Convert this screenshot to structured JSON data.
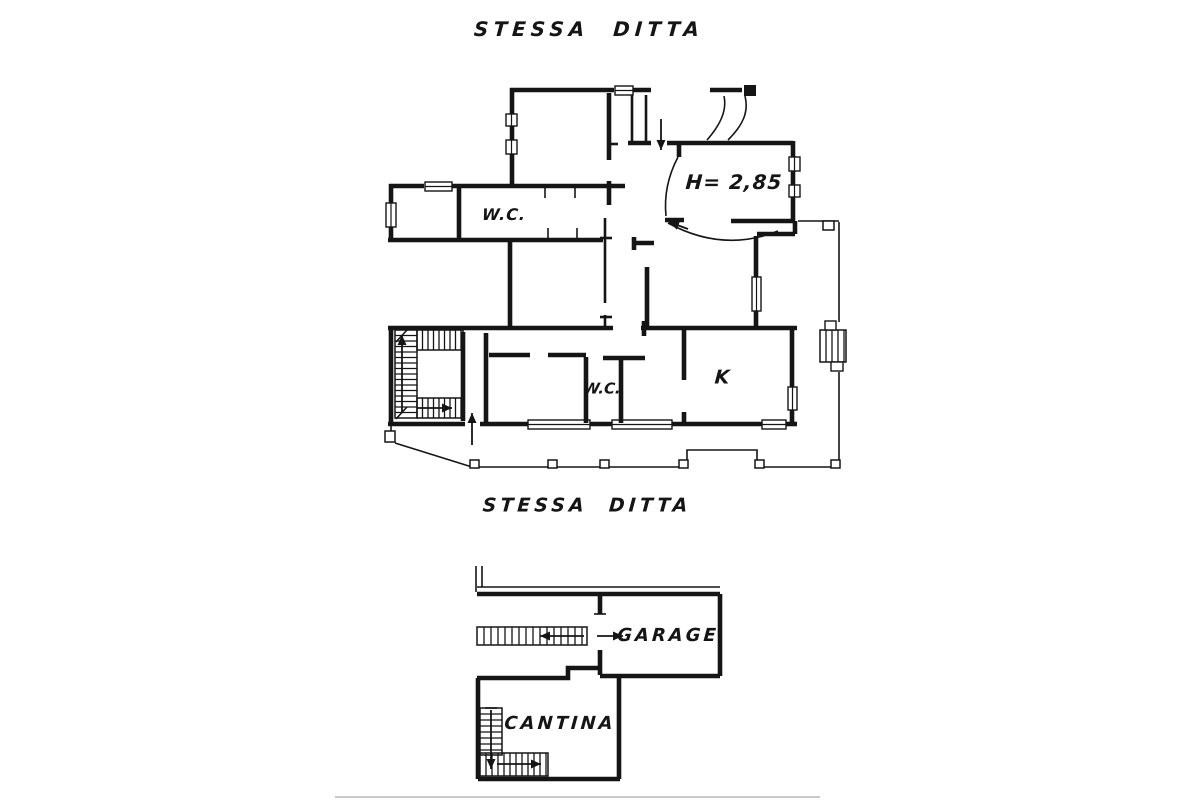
{
  "colors": {
    "ink": "#151515",
    "paper": "#ffffff",
    "faint": "#c9c9c9"
  },
  "labels": [
    {
      "id": "title-upper",
      "text": "STESSA  DITTA",
      "x": 589,
      "y": 29,
      "size": 20,
      "ls": 5
    },
    {
      "id": "title-lower",
      "text": "STESSA  DITTA",
      "x": 587,
      "y": 506,
      "size": 19,
      "ls": 4
    },
    {
      "id": "wc-upper",
      "text": "W.C.",
      "x": 504,
      "y": 215,
      "size": 16,
      "ls": 1
    },
    {
      "id": "height-note",
      "text": "H= 2,85",
      "x": 734,
      "y": 182,
      "size": 20,
      "ls": 1
    },
    {
      "id": "wc-lower",
      "text": "W.C.",
      "x": 602,
      "y": 389,
      "size": 15,
      "ls": 0
    },
    {
      "id": "kitchen",
      "text": "K",
      "x": 722,
      "y": 378,
      "size": 19,
      "ls": 0
    },
    {
      "id": "garage",
      "text": "GARAGE",
      "x": 668,
      "y": 636,
      "size": 18,
      "ls": 3
    },
    {
      "id": "cantina",
      "text": "CANTINA",
      "x": 560,
      "y": 724,
      "size": 18,
      "ls": 3
    }
  ],
  "drawing": {
    "thick": [
      "M 510,90 H 614",
      "M 633,90 H 651",
      "M 512,88 V 114",
      "M 512,126 V 140",
      "M 512,154 V 185",
      "M 628,143 H 651",
      "M 609,93 V 160",
      "M 609,181 V 205",
      "M 389,186 H 424",
      "M 452,186 H 625",
      "M 391,184 V 203",
      "M 391,227 V 242",
      "M 388,240 H 603",
      "M 459,188 V 238",
      "M 510,240 V 328",
      "M 667,143 H 793",
      "M 679,145 V 157",
      "M 665,220 H 684",
      "M 793,141 V 157",
      "M 793,171 V 185",
      "M 793,197 V 223",
      "M 731,221 H 795",
      "M 795,221 V 234",
      "M 757,234 H 795",
      "M 756,236 V 277",
      "M 756,311 V 330",
      "M 634,243 H 654",
      "M 634,237 V 250",
      "M 647,267 V 328",
      "M 388,328 H 613",
      "M 641,328 H 797",
      "M 644,321 V 336",
      "M 684,330 V 380",
      "M 684,412 V 423",
      "M 792,330 V 387",
      "M 792,410 V 423",
      "M 391,330 V 424",
      "M 463,332 V 421",
      "M 486,333 V 423",
      "M 489,355 H 530",
      "M 548,355 H 586",
      "M 586,357 V 423",
      "M 603,358 H 645",
      "M 621,360 V 423",
      "M 388,424 H 465",
      "M 480,424 H 528",
      "M 590,424 H 612",
      "M 672,424 H 762",
      "M 786,424 H 797",
      "M 710,90 H 742",
      "M 477,594 H 720",
      "M 600,596 V 614",
      "M 600,650 V 675",
      "M 720,594 V 676",
      "M 600,676 H 720",
      "M 477,678 H 568 V 668 H 598",
      "M 478,678 V 779",
      "M 478,779 H 620",
      "M 619,678 V 779"
    ],
    "medium": [
      "M 632,95 V 141",
      "M 646,95 V 141",
      "M 605,218 V 303",
      "M 600,238 H 612",
      "M 605,315 V 327",
      "M 600,317 H 612",
      "M 609,144 H 618"
    ],
    "thin": [
      "M 477,587 H 720",
      "M 476,566 V 592",
      "M 482,566 V 587",
      "M 594,614 H 606",
      "M 678,157 C 668,176 664,196 666,216",
      "M 668,223 Q 723,253 778,231",
      "M 745,96 C 749,112 743,125 728,140",
      "M 724,96 C 727,110 721,124 707,140",
      "M 391,426 V 442",
      "M 395,443 L 472,467",
      "M 472,467 H 687",
      "M 687,467 V 450 H 757 V 467",
      "M 757,467 H 839",
      "M 839,467 V 372",
      "M 839,322 V 222",
      "M 798,221 H 839",
      "M 548,228 V 239",
      "M 577,228 V 239",
      "M 545,188 V 198",
      "M 575,188 V 198",
      "M 485,708 H 497",
      "M 396,342 L 407,330",
      "M 396,419 L 407,407"
    ],
    "faint": [
      "M 335,797 H 820"
    ],
    "windows": [
      {
        "x": 615,
        "y": 86,
        "w": 18,
        "h": 9
      },
      {
        "x": 425,
        "y": 182,
        "w": 27,
        "h": 9
      },
      {
        "x": 386,
        "y": 203,
        "w": 10,
        "h": 24
      },
      {
        "x": 506,
        "y": 114,
        "w": 11,
        "h": 12
      },
      {
        "x": 506,
        "y": 140,
        "w": 11,
        "h": 14
      },
      {
        "x": 789,
        "y": 157,
        "w": 11,
        "h": 14
      },
      {
        "x": 789,
        "y": 185,
        "w": 11,
        "h": 12
      },
      {
        "x": 752,
        "y": 277,
        "w": 9,
        "h": 34
      },
      {
        "x": 788,
        "y": 387,
        "w": 9,
        "h": 23
      },
      {
        "x": 528,
        "y": 420,
        "w": 62,
        "h": 9
      },
      {
        "x": 612,
        "y": 420,
        "w": 60,
        "h": 9
      },
      {
        "x": 762,
        "y": 420,
        "w": 24,
        "h": 9
      }
    ],
    "hatches": [
      {
        "x": 417,
        "y": 330,
        "w": 46,
        "h": 20,
        "dir": "v",
        "step": 5.5
      },
      {
        "x": 395,
        "y": 330,
        "w": 22,
        "h": 88,
        "dir": "h",
        "step": 5.5
      },
      {
        "x": 417,
        "y": 398,
        "w": 46,
        "h": 20,
        "dir": "v",
        "step": 5.5
      },
      {
        "x": 477,
        "y": 627,
        "w": 110,
        "h": 18,
        "dir": "v",
        "step": 7
      },
      {
        "x": 480,
        "y": 708,
        "w": 22,
        "h": 47,
        "dir": "h",
        "step": 6
      },
      {
        "x": 480,
        "y": 753,
        "w": 68,
        "h": 23,
        "dir": "v",
        "step": 6
      },
      {
        "x": 820,
        "y": 330,
        "w": 26,
        "h": 32,
        "dir": "v",
        "step": 6
      }
    ],
    "tabs": [
      {
        "x": 825,
        "y": 321,
        "w": 11,
        "h": 9
      },
      {
        "x": 831,
        "y": 362,
        "w": 12,
        "h": 9
      }
    ],
    "posts": [
      {
        "x": 385,
        "y": 431,
        "w": 10,
        "h": 11
      },
      {
        "x": 470,
        "y": 460,
        "w": 9,
        "h": 8
      },
      {
        "x": 548,
        "y": 460,
        "w": 9,
        "h": 8
      },
      {
        "x": 600,
        "y": 460,
        "w": 9,
        "h": 8
      },
      {
        "x": 679,
        "y": 460,
        "w": 9,
        "h": 8
      },
      {
        "x": 755,
        "y": 460,
        "w": 9,
        "h": 8
      },
      {
        "x": 831,
        "y": 460,
        "w": 9,
        "h": 8
      },
      {
        "x": 823,
        "y": 221,
        "w": 11,
        "h": 9
      }
    ],
    "blocks": [
      {
        "x": 744,
        "y": 85,
        "w": 12,
        "h": 11
      }
    ],
    "arrows": [
      {
        "x1": 661,
        "y1": 119,
        "x2": 661,
        "y2": 150
      },
      {
        "x1": 402,
        "y1": 413,
        "x2": 402,
        "y2": 335
      },
      {
        "x1": 417,
        "y1": 408,
        "x2": 452,
        "y2": 408
      },
      {
        "x1": 472,
        "y1": 445,
        "x2": 472,
        "y2": 413
      },
      {
        "x1": 688,
        "y1": 229,
        "x2": 669,
        "y2": 222
      },
      {
        "x1": 584,
        "y1": 636,
        "x2": 540,
        "y2": 636
      },
      {
        "x1": 597,
        "y1": 636,
        "x2": 623,
        "y2": 636
      },
      {
        "x1": 491,
        "y1": 710,
        "x2": 491,
        "y2": 769
      },
      {
        "x1": 497,
        "y1": 764,
        "x2": 541,
        "y2": 764
      }
    ]
  }
}
